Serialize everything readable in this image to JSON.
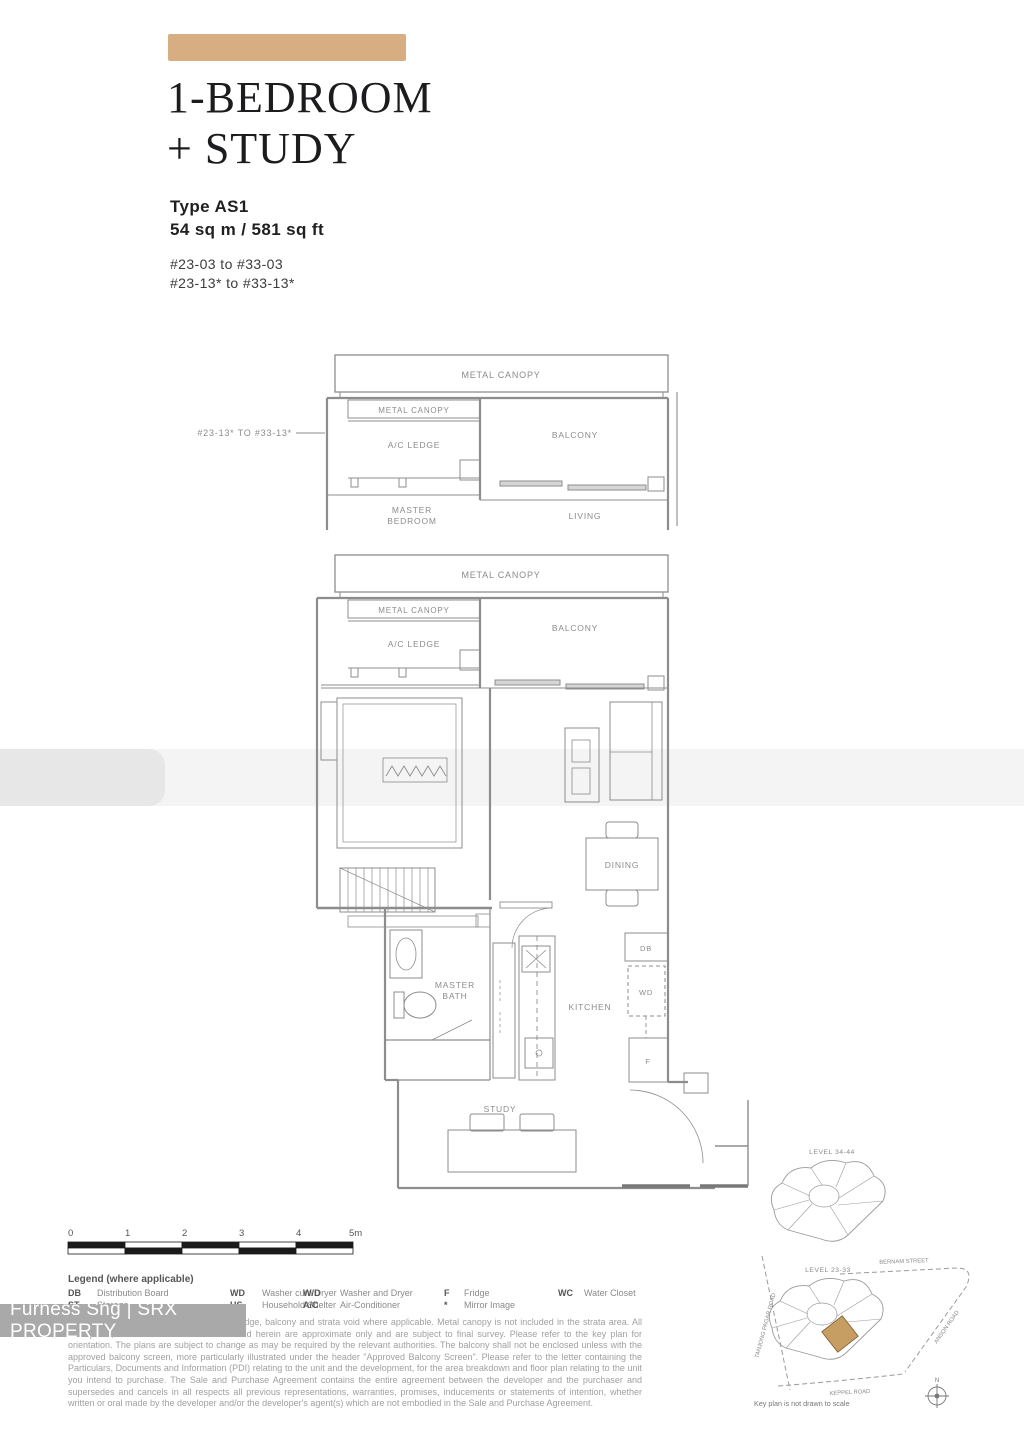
{
  "header": {
    "accent_color": "#d7ad82",
    "title_line1": "1-BEDROOM",
    "title_line2": "+ STUDY",
    "type_label": "Type AS1",
    "area_label": "54  sq m / 581 sq ft",
    "units_line1": "#23-03 to #33-03",
    "units_line2": "#23-13* to #33-13*"
  },
  "upper_plan": {
    "callout": "#23-13* TO #33-13*",
    "labels": {
      "metal_canopy_outer": "METAL CANOPY",
      "metal_canopy_inner": "METAL CANOPY",
      "ac_ledge": "A/C LEDGE",
      "balcony": "BALCONY",
      "master_bedroom_1": "MASTER",
      "master_bedroom_2": "BEDROOM",
      "living": "LIVING"
    }
  },
  "main_plan": {
    "labels": {
      "metal_canopy_outer": "METAL CANOPY",
      "metal_canopy_inner": "METAL CANOPY",
      "ac_ledge": "A/C LEDGE",
      "balcony": "BALCONY",
      "dining": "DINING",
      "master_bath_1": "MASTER",
      "master_bath_2": "BATH",
      "kitchen": "KITCHEN",
      "study": "STUDY",
      "db": "DB",
      "wd": "WD",
      "fridge": "F"
    }
  },
  "scale_bar": {
    "ticks": [
      "0",
      "1",
      "2",
      "3",
      "4",
      "5m"
    ]
  },
  "legend": {
    "title": "Legend (where applicable)",
    "items": [
      {
        "abbr": "DB",
        "label": "Distribution Board"
      },
      {
        "abbr": "ST",
        "label": "Storage"
      },
      {
        "abbr": "WD",
        "label": "Washer cum Dryer"
      },
      {
        "abbr": "HS",
        "label": "Household Shelter"
      },
      {
        "abbr": "W/D",
        "label": "Washer and Dryer"
      },
      {
        "abbr": "A/C",
        "label": "Air-Conditioner"
      },
      {
        "abbr": "F",
        "label": "Fridge"
      },
      {
        "abbr": "*",
        "label": "Mirror Image"
      },
      {
        "abbr": "WC",
        "label": "Water Closet"
      }
    ]
  },
  "disclaimer": "Strata area includes air-conditioner (A/C) ledge, balcony and strata void where applicable. Metal canopy is not included in the strata area. All floor plans, areas and measurements stated herein are approximate only and are subject to final survey. Please refer to the key plan for orientation. The plans are subject to change as may be required by the relevant authorities. The balcony shall not be enclosed unless with the approved balcony screen, more particularly illustrated under the header \"Approved Balcony Screen\". Please refer to the letter containing the Particulars, Documents and Information (PDI) relating to the unit and the development, for the area breakdown and floor plan relating to the unit you intend to purchase. The Sale and Purchase Agreement contains the entire agreement between the developer and the purchaser and supersedes and cancels in all respects all previous representations, warranties, promises, inducements or statements of intention, whether written or oral made by the developer and/or the developer's agent(s) which are not embodied in the Sale and Purchase Agreement.",
  "watermark": {
    "text": "Furness Sng | SRX PROPERTY",
    "bg": "#a9a9a9",
    "fg": "#ffffff"
  },
  "key_plan": {
    "level_upper": "LEVEL 34-44",
    "level_lower": "LEVEL 23-33",
    "roads": {
      "bernam": "BERNAM STREET",
      "anson": "ANSON ROAD",
      "keppel": "KEPPEL ROAD",
      "tanjong_pagar": "TANJONG PAGAR ROAD"
    },
    "note": "Key plan is not drawn to scale",
    "north": "N",
    "highlight_color": "#c69d62"
  }
}
